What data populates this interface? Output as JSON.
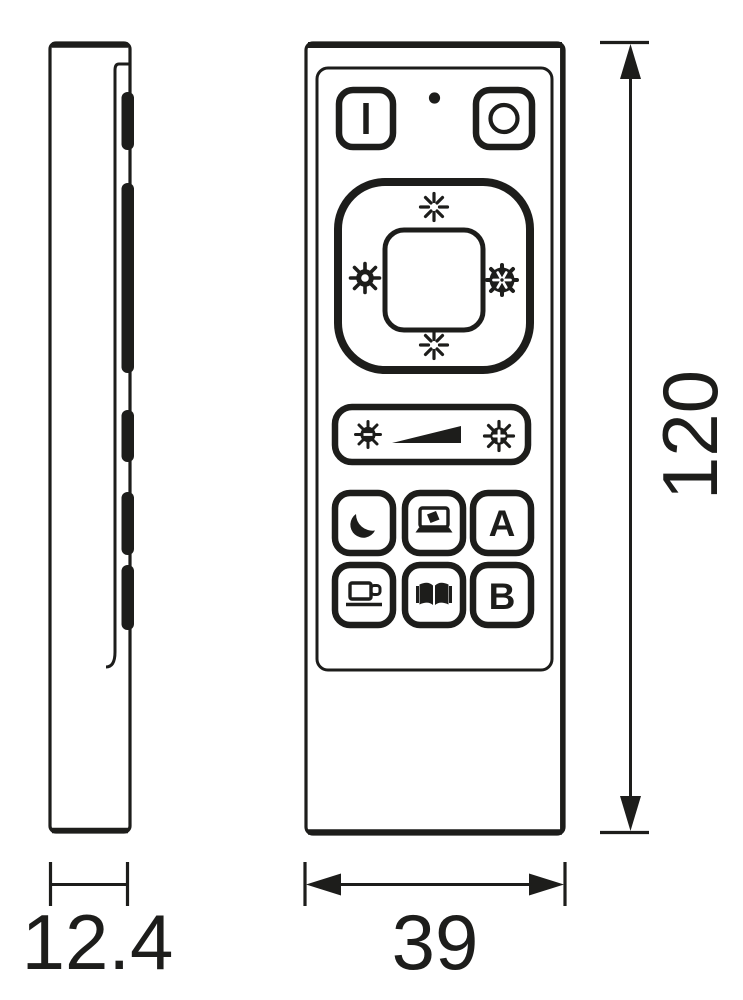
{
  "dimension_labels": {
    "height": "120",
    "width": "39",
    "depth": "12.4"
  },
  "front_view": {
    "scene_a_label": "A",
    "scene_b_label": "B",
    "icons": {
      "power_on": "vertical-bar",
      "status_led": "small-dot",
      "power_off": "circle-ring",
      "brightness_up": "ray-burst",
      "brightness_down": "ray-burst",
      "warm_white": "sun-gear",
      "cool_white": "snowflake-in-circle",
      "dim_down": "sun-with-minus",
      "dim_ramp": "rising-wedge-triangle",
      "dim_up": "sun-with-plus",
      "night_mode": "crescent-moon",
      "screen_mode": "laptop",
      "coffee_mode": "coffee-cup",
      "reading_mode": "open-book"
    }
  },
  "side_view": {
    "button_bumps": 5
  },
  "colors": {
    "line": "#1d1d1b",
    "background": "#ffffff"
  }
}
